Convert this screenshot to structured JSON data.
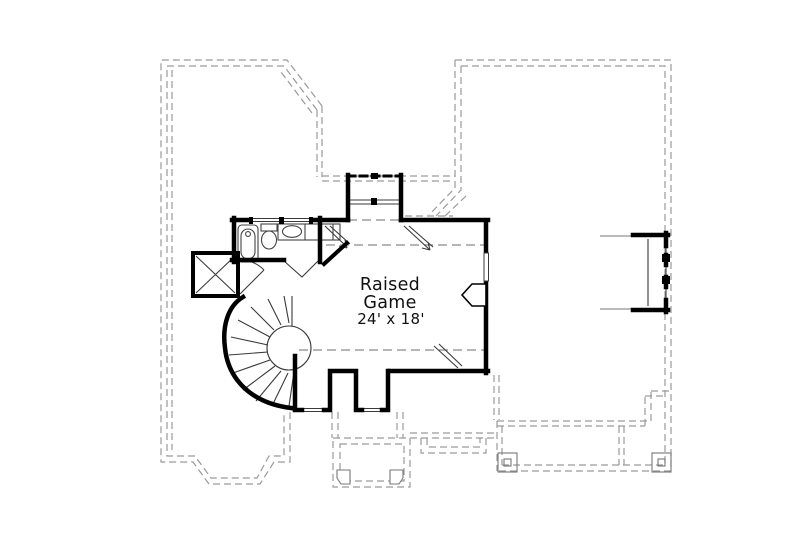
{
  "plan": {
    "type": "second-floor-plan",
    "room": {
      "label_line1": "Raised",
      "label_line2": "Game",
      "dimensions": "24' x 18'"
    },
    "colors": {
      "wall": "#000000",
      "thin_line": "#3a3a3a",
      "fixture_line": "#444444",
      "dashed_outline": "#9a9a9a",
      "detail_gray": "#777777",
      "text": "#111111",
      "background": "#ffffff"
    },
    "elements": [
      "game-room",
      "bathroom",
      "bathtub",
      "toilet",
      "vanity-sink",
      "spiral-staircase",
      "mechanical-chase",
      "dormer-window",
      "south-window-bays",
      "east-window-bay",
      "roof-outline",
      "porch-outline",
      "porch-posts",
      "chimney",
      "attic-arrow"
    ]
  }
}
